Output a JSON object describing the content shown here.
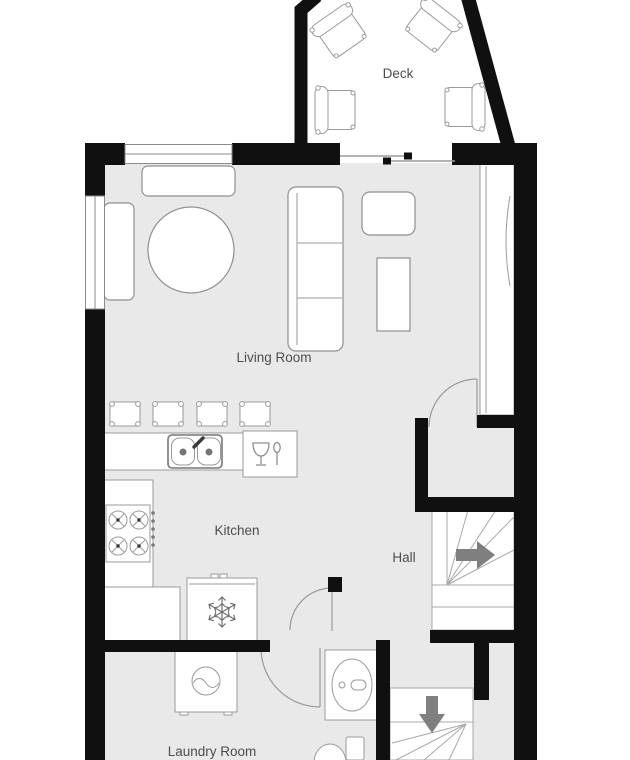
{
  "floorplan": {
    "rooms": [
      {
        "name": "Deck"
      },
      {
        "name": "Living Room"
      },
      {
        "name": "Kitchen"
      },
      {
        "name": "Hall"
      },
      {
        "name": "Laundry Room"
      }
    ],
    "fixtures": [
      "deck-chair",
      "bench",
      "sideboard",
      "round-dining-table",
      "sofa",
      "armchair",
      "side-table",
      "wardrobe-closet",
      "bar-stool",
      "kitchen-counter",
      "double-sink",
      "dishwasher",
      "cooktop",
      "refrigerator",
      "washing-machine",
      "bathroom-sink",
      "toilet",
      "staircase-up",
      "staircase-down"
    ],
    "stairs": {
      "up_arrow_direction": "right",
      "down_arrow_direction": "down"
    },
    "colors": {
      "wall": "#101010",
      "interior_floor": "#e9e9e9",
      "deck_floor": "#ffffff",
      "furniture_outline": "#8f8f8f",
      "label_text": "#4d4d4d",
      "stair_arrow": "#7f7f7f"
    }
  }
}
